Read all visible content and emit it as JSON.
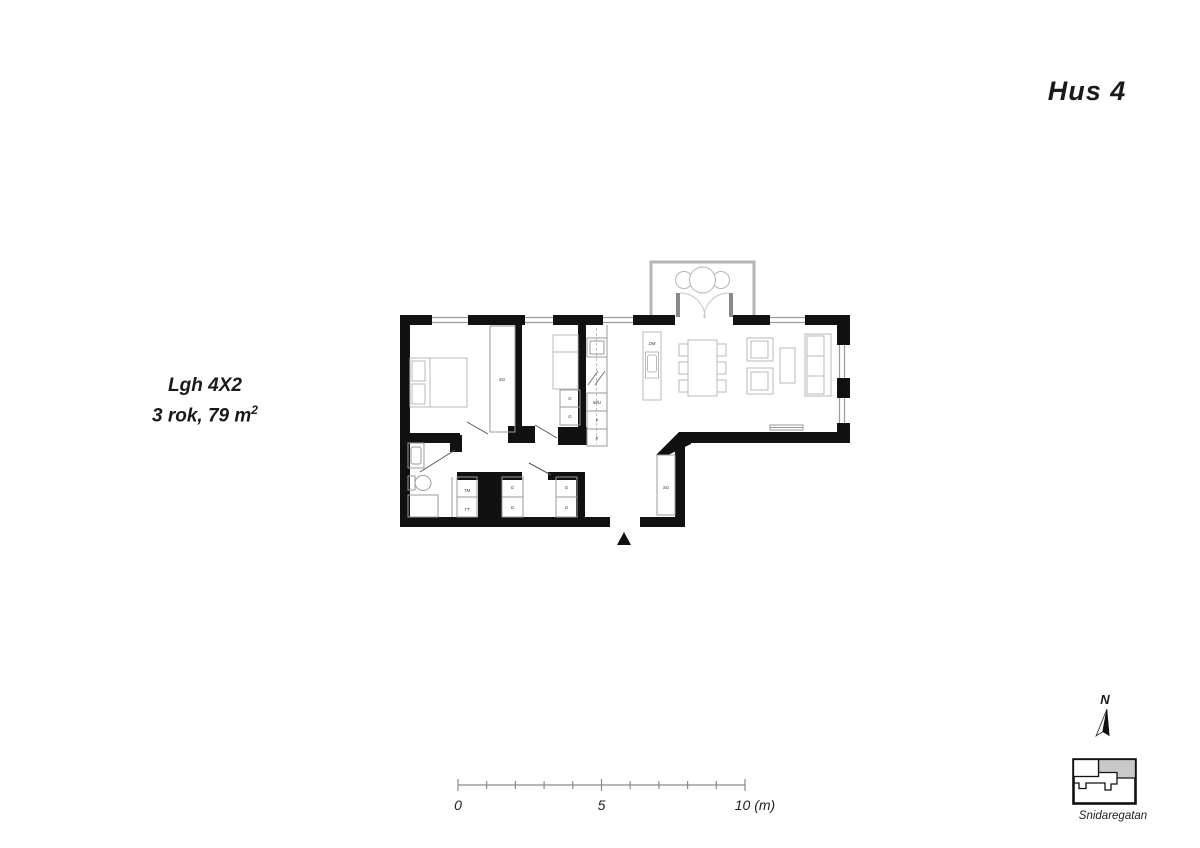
{
  "header": {
    "title": "Hus 4"
  },
  "apartment": {
    "id": "Lgh 4X2",
    "rooms_line": "3 rok, 79 m",
    "area_sup": "2"
  },
  "plan": {
    "labels": {
      "sg_bedroom": "SG",
      "sg_hall": "SG",
      "dm": "DM",
      "mu": "M/U",
      "f": "F",
      "k": "K",
      "tm": "TM",
      "tt": "TT",
      "g_room2_a": "G",
      "g_room2_b": "G",
      "g_hall_1a": "G",
      "g_hall_1b": "G",
      "g_hall_2a": "G",
      "g_hall_2b": "G"
    }
  },
  "scale_bar": {
    "zero": "0",
    "five": "5",
    "ten": "10 (m)"
  },
  "compass": {
    "north": "N"
  },
  "key_plan": {
    "street": "Snidaregatan"
  },
  "colors": {
    "wall": "#111111",
    "furniture": "#b6babc",
    "balcony": "#b5b5b5",
    "highlight": "#c9c9c9"
  }
}
